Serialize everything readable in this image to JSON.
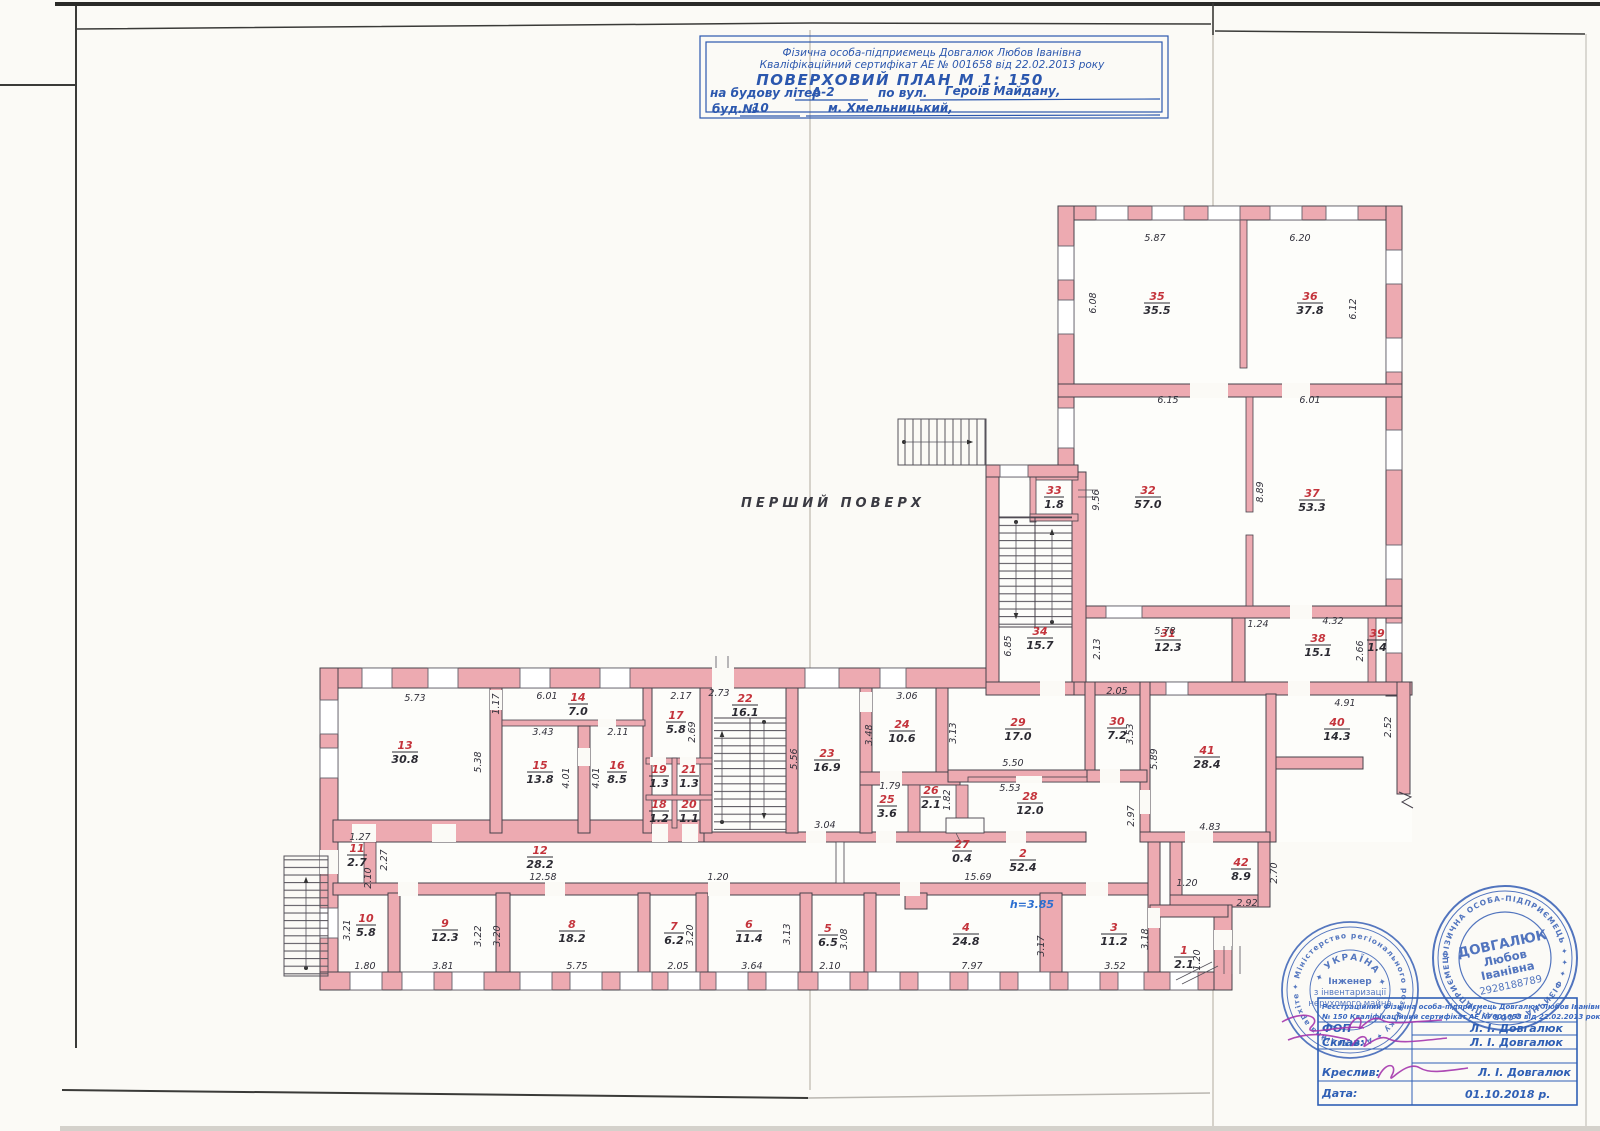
{
  "page": {
    "floor_label": "ПЕРШИЙ ПОВЕРХ"
  },
  "title_block": {
    "line1": "Фізична особа-підприємець Довгалюк Любов Іванівна",
    "line2": "Кваліфікаційний сертифікат АЕ № 001658 від 22.02.2013 року",
    "line3": "ПОВЕРХОВИЙ  ПЛАН     М 1: 150",
    "line4a": "на будову літер",
    "line4b": "А-2",
    "line4c": "по вул.",
    "line4d": "Героїв Майдану,",
    "line5a": "буд.№",
    "line5b": "10",
    "line5c": "м. Хмельницький,"
  },
  "plan": {
    "height_note": "h=3.85",
    "rooms": [
      {
        "n": "1",
        "a": "2.1",
        "x": 1184,
        "y": 957
      },
      {
        "n": "2",
        "a": "52.4",
        "x": 1023,
        "y": 860
      },
      {
        "n": "3",
        "a": "11.2",
        "x": 1114,
        "y": 934
      },
      {
        "n": "4",
        "a": "24.8",
        "x": 966,
        "y": 934
      },
      {
        "n": "5",
        "a": "6.5",
        "x": 828,
        "y": 935
      },
      {
        "n": "6",
        "a": "11.4",
        "x": 749,
        "y": 931
      },
      {
        "n": "7",
        "a": "6.2",
        "x": 674,
        "y": 933
      },
      {
        "n": "8",
        "a": "18.2",
        "x": 572,
        "y": 931
      },
      {
        "n": "9",
        "a": "12.3",
        "x": 445,
        "y": 930
      },
      {
        "n": "10",
        "a": "5.8",
        "x": 366,
        "y": 925
      },
      {
        "n": "11",
        "a": "2.7",
        "x": 357,
        "y": 855
      },
      {
        "n": "12",
        "a": "28.2",
        "x": 540,
        "y": 857
      },
      {
        "n": "13",
        "a": "30.8",
        "x": 405,
        "y": 752
      },
      {
        "n": "14",
        "a": "7.0",
        "x": 578,
        "y": 704
      },
      {
        "n": "15",
        "a": "13.8",
        "x": 540,
        "y": 772
      },
      {
        "n": "16",
        "a": "8.5",
        "x": 617,
        "y": 772
      },
      {
        "n": "17",
        "a": "5.8",
        "x": 676,
        "y": 722
      },
      {
        "n": "18",
        "a": "1.2",
        "x": 659,
        "y": 811
      },
      {
        "n": "19",
        "a": "1.3",
        "x": 659,
        "y": 776
      },
      {
        "n": "20",
        "a": "1.1",
        "x": 689,
        "y": 811
      },
      {
        "n": "21",
        "a": "1.3",
        "x": 689,
        "y": 776
      },
      {
        "n": "22",
        "a": "16.1",
        "x": 745,
        "y": 705
      },
      {
        "n": "23",
        "a": "16.9",
        "x": 827,
        "y": 760
      },
      {
        "n": "24",
        "a": "10.6",
        "x": 902,
        "y": 731
      },
      {
        "n": "25",
        "a": "3.6",
        "x": 887,
        "y": 806
      },
      {
        "n": "26",
        "a": "2.1",
        "x": 931,
        "y": 797
      },
      {
        "n": "27",
        "a": "0.4",
        "x": 962,
        "y": 851
      },
      {
        "n": "28",
        "a": "12.0",
        "x": 1030,
        "y": 803
      },
      {
        "n": "29",
        "a": "17.0",
        "x": 1018,
        "y": 729
      },
      {
        "n": "30",
        "a": "7.2",
        "x": 1117,
        "y": 728
      },
      {
        "n": "31",
        "a": "12.3",
        "x": 1168,
        "y": 640
      },
      {
        "n": "32",
        "a": "57.0",
        "x": 1148,
        "y": 497
      },
      {
        "n": "33",
        "a": "1.8",
        "x": 1054,
        "y": 497
      },
      {
        "n": "34",
        "a": "15.7",
        "x": 1040,
        "y": 638
      },
      {
        "n": "35",
        "a": "35.5",
        "x": 1157,
        "y": 303
      },
      {
        "n": "36",
        "a": "37.8",
        "x": 1310,
        "y": 303
      },
      {
        "n": "37",
        "a": "53.3",
        "x": 1312,
        "y": 500
      },
      {
        "n": "38",
        "a": "15.1",
        "x": 1318,
        "y": 645
      },
      {
        "n": "39",
        "a": "1.4",
        "x": 1377,
        "y": 640
      },
      {
        "n": "40",
        "a": "14.3",
        "x": 1337,
        "y": 729
      },
      {
        "n": "41",
        "a": "28.4",
        "x": 1207,
        "y": 757
      },
      {
        "n": "42",
        "a": "8.9",
        "x": 1241,
        "y": 869
      }
    ],
    "dims": [
      {
        "t": "5.87",
        "x": 1155,
        "y": 241,
        "r": 0
      },
      {
        "t": "6.20",
        "x": 1300,
        "y": 241,
        "r": 0
      },
      {
        "t": "6.08",
        "x": 1096,
        "y": 303,
        "r": 1
      },
      {
        "t": "6.12",
        "x": 1356,
        "y": 309,
        "r": 1
      },
      {
        "t": "6.15",
        "x": 1168,
        "y": 403,
        "r": 0
      },
      {
        "t": "6.01",
        "x": 1310,
        "y": 403,
        "r": 0
      },
      {
        "t": "9.56",
        "x": 1099,
        "y": 500,
        "r": 1
      },
      {
        "t": "8.89",
        "x": 1263,
        "y": 492,
        "r": 1
      },
      {
        "t": "5.78",
        "x": 1165,
        "y": 634,
        "r": 0
      },
      {
        "t": "2.13",
        "x": 1100,
        "y": 649,
        "r": 1
      },
      {
        "t": "1.24",
        "x": 1258,
        "y": 627,
        "r": 0
      },
      {
        "t": "4.32",
        "x": 1333,
        "y": 624,
        "r": 0
      },
      {
        "t": "2.66",
        "x": 1363,
        "y": 651,
        "r": 1
      },
      {
        "t": "6.85",
        "x": 1011,
        "y": 646,
        "r": 1
      },
      {
        "t": "2.05",
        "x": 1117,
        "y": 694,
        "r": 0
      },
      {
        "t": "3.53",
        "x": 1133,
        "y": 734,
        "r": 1
      },
      {
        "t": "5.89",
        "x": 1157,
        "y": 759,
        "r": 1
      },
      {
        "t": "2.97",
        "x": 1134,
        "y": 816,
        "r": 1
      },
      {
        "t": "4.83",
        "x": 1210,
        "y": 830,
        "r": 0
      },
      {
        "t": "4.91",
        "x": 1345,
        "y": 706,
        "r": 0
      },
      {
        "t": "2.52",
        "x": 1391,
        "y": 727,
        "r": 1
      },
      {
        "t": "2.70",
        "x": 1277,
        "y": 873,
        "r": 1
      },
      {
        "t": "2.92",
        "x": 1247,
        "y": 906,
        "r": 0
      },
      {
        "t": "5.73",
        "x": 415,
        "y": 701,
        "r": 0
      },
      {
        "t": "1.17",
        "x": 499,
        "y": 704,
        "r": 1
      },
      {
        "t": "6.01",
        "x": 547,
        "y": 699,
        "r": 0
      },
      {
        "t": "5.38",
        "x": 481,
        "y": 762,
        "r": 1
      },
      {
        "t": "3.43",
        "x": 543,
        "y": 735,
        "r": 0
      },
      {
        "t": "2.11",
        "x": 618,
        "y": 735,
        "r": 0
      },
      {
        "t": "4.01",
        "x": 569,
        "y": 778,
        "r": 1
      },
      {
        "t": "4.01",
        "x": 599,
        "y": 778,
        "r": 1
      },
      {
        "t": "2.17",
        "x": 681,
        "y": 699,
        "r": 0
      },
      {
        "t": "2.69",
        "x": 695,
        "y": 732,
        "r": 1
      },
      {
        "t": "2.73",
        "x": 719,
        "y": 696,
        "r": 0
      },
      {
        "t": "5.56",
        "x": 797,
        "y": 759,
        "r": 1
      },
      {
        "t": "3.04",
        "x": 825,
        "y": 828,
        "r": 0
      },
      {
        "t": "3.06",
        "x": 907,
        "y": 699,
        "r": 0
      },
      {
        "t": "3.48",
        "x": 872,
        "y": 735,
        "r": 1
      },
      {
        "t": "3.13",
        "x": 956,
        "y": 733,
        "r": 1
      },
      {
        "t": "5.50",
        "x": 1013,
        "y": 766,
        "r": 0
      },
      {
        "t": "5.53",
        "x": 1010,
        "y": 791,
        "r": 0
      },
      {
        "t": "1.79",
        "x": 890,
        "y": 789,
        "r": 0
      },
      {
        "t": "1.82",
        "x": 950,
        "y": 800,
        "r": 1
      },
      {
        "t": "1.27",
        "x": 360,
        "y": 840,
        "r": 0
      },
      {
        "t": "2.27",
        "x": 387,
        "y": 860,
        "r": 1
      },
      {
        "t": "2.10",
        "x": 371,
        "y": 878,
        "r": 1
      },
      {
        "t": "12.58",
        "x": 543,
        "y": 880,
        "r": 0
      },
      {
        "t": "15.69",
        "x": 978,
        "y": 880,
        "r": 0
      },
      {
        "t": "1.20",
        "x": 718,
        "y": 880,
        "r": 0
      },
      {
        "t": "3.21",
        "x": 350,
        "y": 930,
        "r": 1
      },
      {
        "t": "1.80",
        "x": 365,
        "y": 969,
        "r": 0
      },
      {
        "t": "3.81",
        "x": 443,
        "y": 969,
        "r": 0
      },
      {
        "t": "3.22",
        "x": 481,
        "y": 936,
        "r": 1
      },
      {
        "t": "3.20",
        "x": 500,
        "y": 936,
        "r": 1
      },
      {
        "t": "5.75",
        "x": 577,
        "y": 969,
        "r": 0
      },
      {
        "t": "2.05",
        "x": 678,
        "y": 969,
        "r": 0
      },
      {
        "t": "3.20",
        "x": 693,
        "y": 935,
        "r": 1
      },
      {
        "t": "3.64",
        "x": 752,
        "y": 969,
        "r": 0
      },
      {
        "t": "3.13",
        "x": 790,
        "y": 934,
        "r": 1
      },
      {
        "t": "2.10",
        "x": 830,
        "y": 969,
        "r": 0
      },
      {
        "t": "3.08",
        "x": 847,
        "y": 939,
        "r": 1
      },
      {
        "t": "7.97",
        "x": 972,
        "y": 969,
        "r": 0
      },
      {
        "t": "3.17",
        "x": 1044,
        "y": 946,
        "r": 1
      },
      {
        "t": "3.52",
        "x": 1115,
        "y": 969,
        "r": 0
      },
      {
        "t": "3.18",
        "x": 1148,
        "y": 939,
        "r": 1
      },
      {
        "t": "1.20",
        "x": 1200,
        "y": 960,
        "r": 1
      },
      {
        "t": "1.20",
        "x": 1187,
        "y": 886,
        "r": 0
      }
    ]
  },
  "stamps": {
    "left": {
      "ring": "✦ Міністерство регіонального розвитку ✦ Атестаційна архітектурно-будівельна комісія ✦ господарства України ✦",
      "arc": "✦ УКРАЇНА ✦",
      "c1": "Інженер",
      "c2": "з інвентаризації",
      "c3": "нерухомого майна"
    },
    "right": {
      "ring": "ФІЗИЧНА ОСОБА-ПІДПРИЄМЕЦЬ ✦ ✦ ✦ ФІЗИЧНА ОСОБА-ПІДПРИЄМЕЦЬ ✦ ✦ ✦",
      "name": "ДОВГАЛЮК",
      "first": "Любов",
      "patro": "Іванівна",
      "code": "2928188789"
    }
  },
  "sign_table": {
    "header1": "Реєстраційний  Фізична особа-підприємець Довгалюк Любов Іванівна",
    "header2": "№ 150  Кваліфікаційний сертифікат АЕ № 001658 від 22.02.2013 року",
    "rows": [
      {
        "label": "ФОП",
        "value": "Л. І. Довгалюк"
      },
      {
        "label": "Склав:",
        "value": "Л. І. Довгалюк"
      },
      {
        "label": "",
        "value": ""
      },
      {
        "label": "Креслив:",
        "value": "Л. І. Довгалюк"
      },
      {
        "label": "Дата:",
        "value": "01.10.2018 р."
      }
    ]
  }
}
